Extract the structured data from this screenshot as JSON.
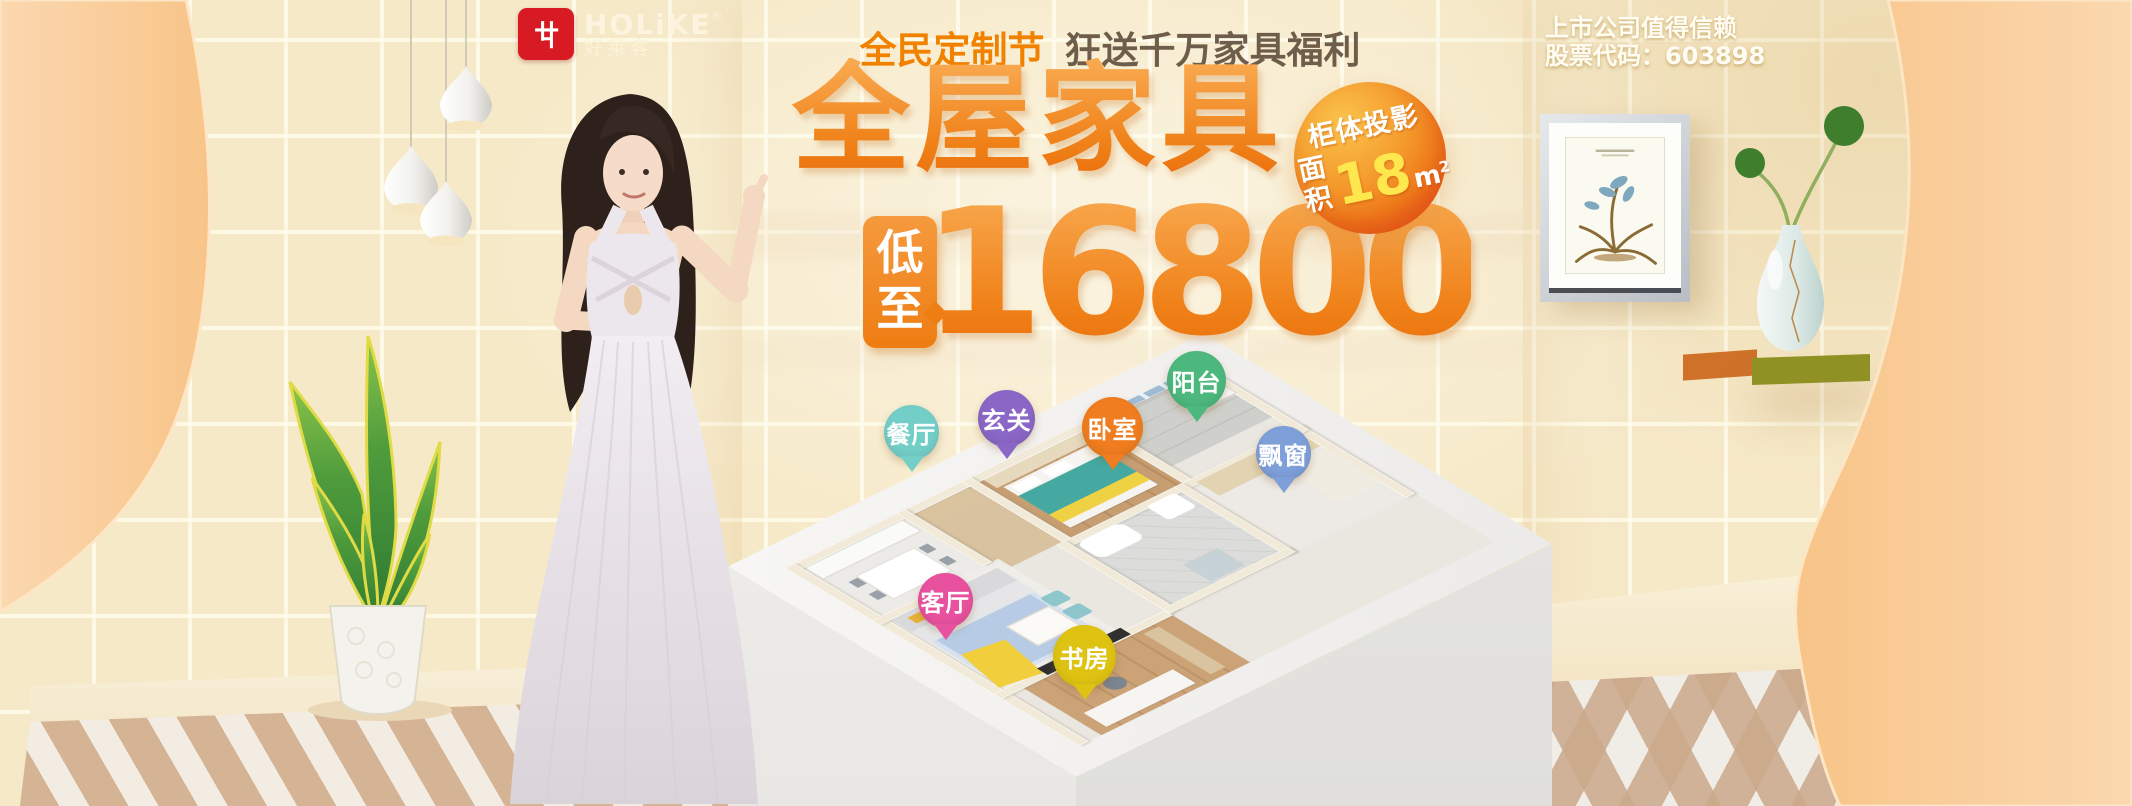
{
  "banner": {
    "brand": {
      "name": "HOLiKE",
      "reg_mark": "®",
      "chinese_name": "好莱客",
      "logo_color": "#D71A23"
    },
    "header": {
      "festival_label": "全民定制节",
      "promo_text": "狂送千万家具福利"
    },
    "hero": {
      "title": "全屋家具",
      "price_tag": {
        "char1": "低",
        "char2": "至"
      },
      "price": "16800",
      "badge": {
        "line1": "柜体投影",
        "line2_label": "面积",
        "value": "18",
        "unit_base": "m",
        "unit_sup": "2"
      }
    },
    "listed_company": {
      "line1": "上市公司值得信赖",
      "line2": "股票代码：603898"
    },
    "floorplan": {
      "rooms": [
        {
          "id": "dining",
          "label": "餐厅",
          "color": "#74CEC8"
        },
        {
          "id": "entry",
          "label": "玄关",
          "color": "#8A67C6"
        },
        {
          "id": "bedroom",
          "label": "卧室",
          "color": "#F07D1F"
        },
        {
          "id": "balcony",
          "label": "阳台",
          "color": "#4DB87D"
        },
        {
          "id": "bay-window",
          "label": "飘窗",
          "color": "#7E9FD8"
        },
        {
          "id": "living-room",
          "label": "客厅",
          "color": "#E8519E"
        },
        {
          "id": "study",
          "label": "书房",
          "color": "#DFC312"
        }
      ]
    },
    "colors": {
      "accent_orange": "#EE7D12",
      "accent_orange_light": "#F9A74B",
      "topline_orange": "#F08200",
      "topline_brown": "#6F5D4B",
      "badge_value_yellow": "#FFE84D",
      "background_beige": "#F6E9C8",
      "drape_peach": "#FBCE9C"
    }
  }
}
